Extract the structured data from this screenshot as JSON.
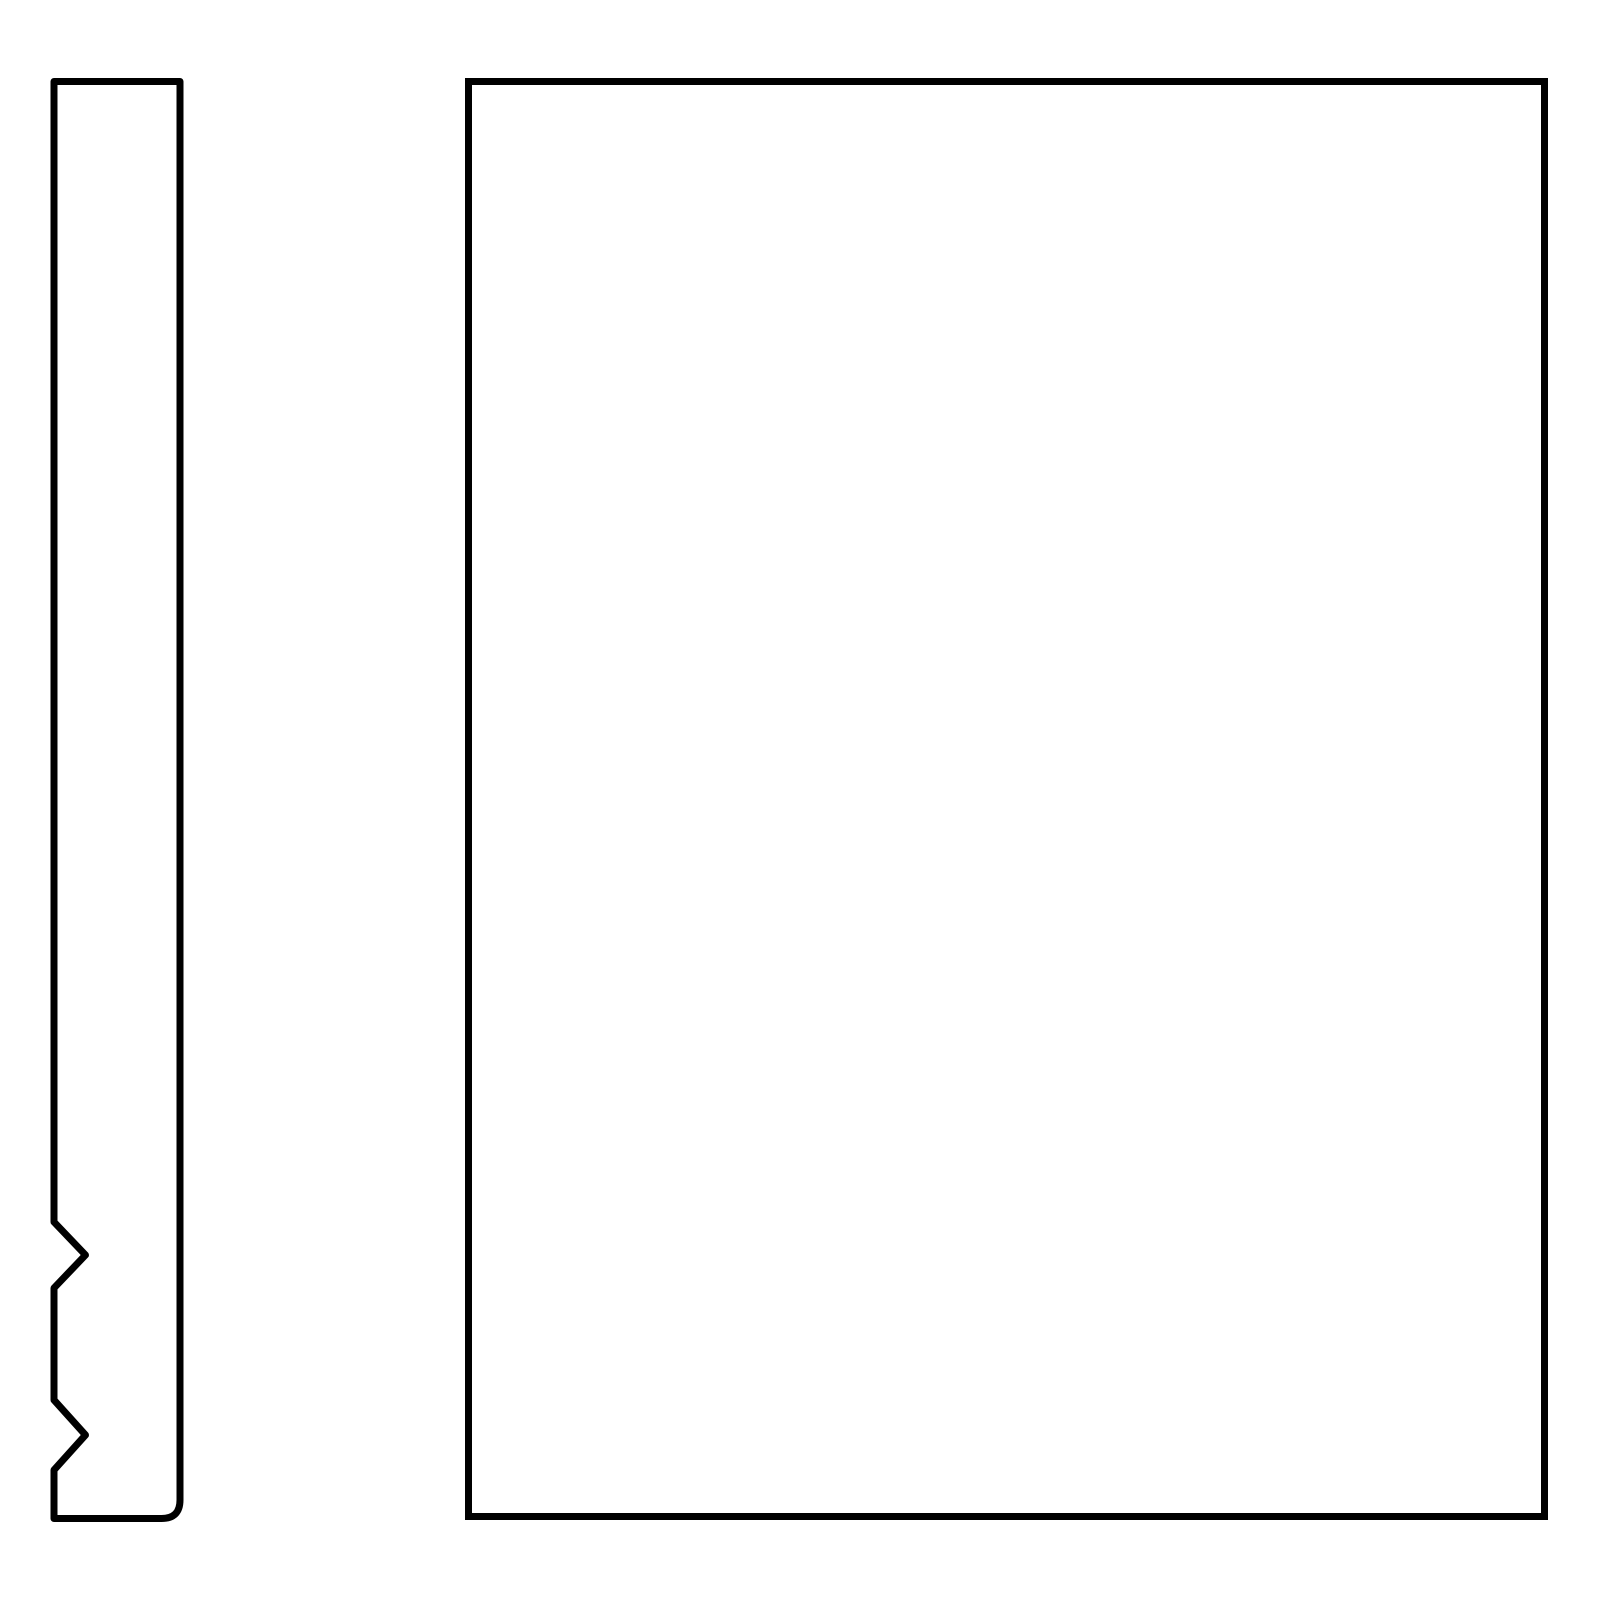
{
  "drawing": {
    "background_color": "#ffffff",
    "stroke_color": "#000000",
    "stroke_width": 7,
    "canvas": {
      "width": 1600,
      "height": 1600
    },
    "shapes": [
      {
        "id": "notched-strip",
        "label": "tall narrow vertical strip outline with two chevron notches on the lower left edge and a rounded bottom-right corner",
        "bounds": {
          "left": 54,
          "top": 81.5,
          "right": 180,
          "bottom": 1518.5
        },
        "notches": [
          {
            "edge": "left",
            "start_y": 1222,
            "apex_x": 85.5,
            "apex_y": 1255,
            "end_y": 1288
          },
          {
            "edge": "left",
            "start_y": 1400,
            "apex_x": 85.5,
            "apex_y": 1435,
            "end_y": 1470
          }
        ],
        "corner_radius_bottom_right": 18.5,
        "path": "M 54 81.5 L 180 81.5 L 180 1500 Q 180 1518.5 161.5 1518.5 L 54 1518.5 L 54 1470 L 85.5 1435 L 54 1400 L 54 1288 L 85.5 1255 L 54 1222 Z"
      },
      {
        "id": "panel-rectangle",
        "label": "large plain rectangle outline with square corners",
        "bounds": {
          "left": 468.5,
          "top": 81.5,
          "right": 1544.5,
          "bottom": 1516.5
        },
        "path": "M 468.5 81.5 L 1544.5 81.5 L 1544.5 1516.5 L 468.5 1516.5 Z"
      }
    ]
  }
}
